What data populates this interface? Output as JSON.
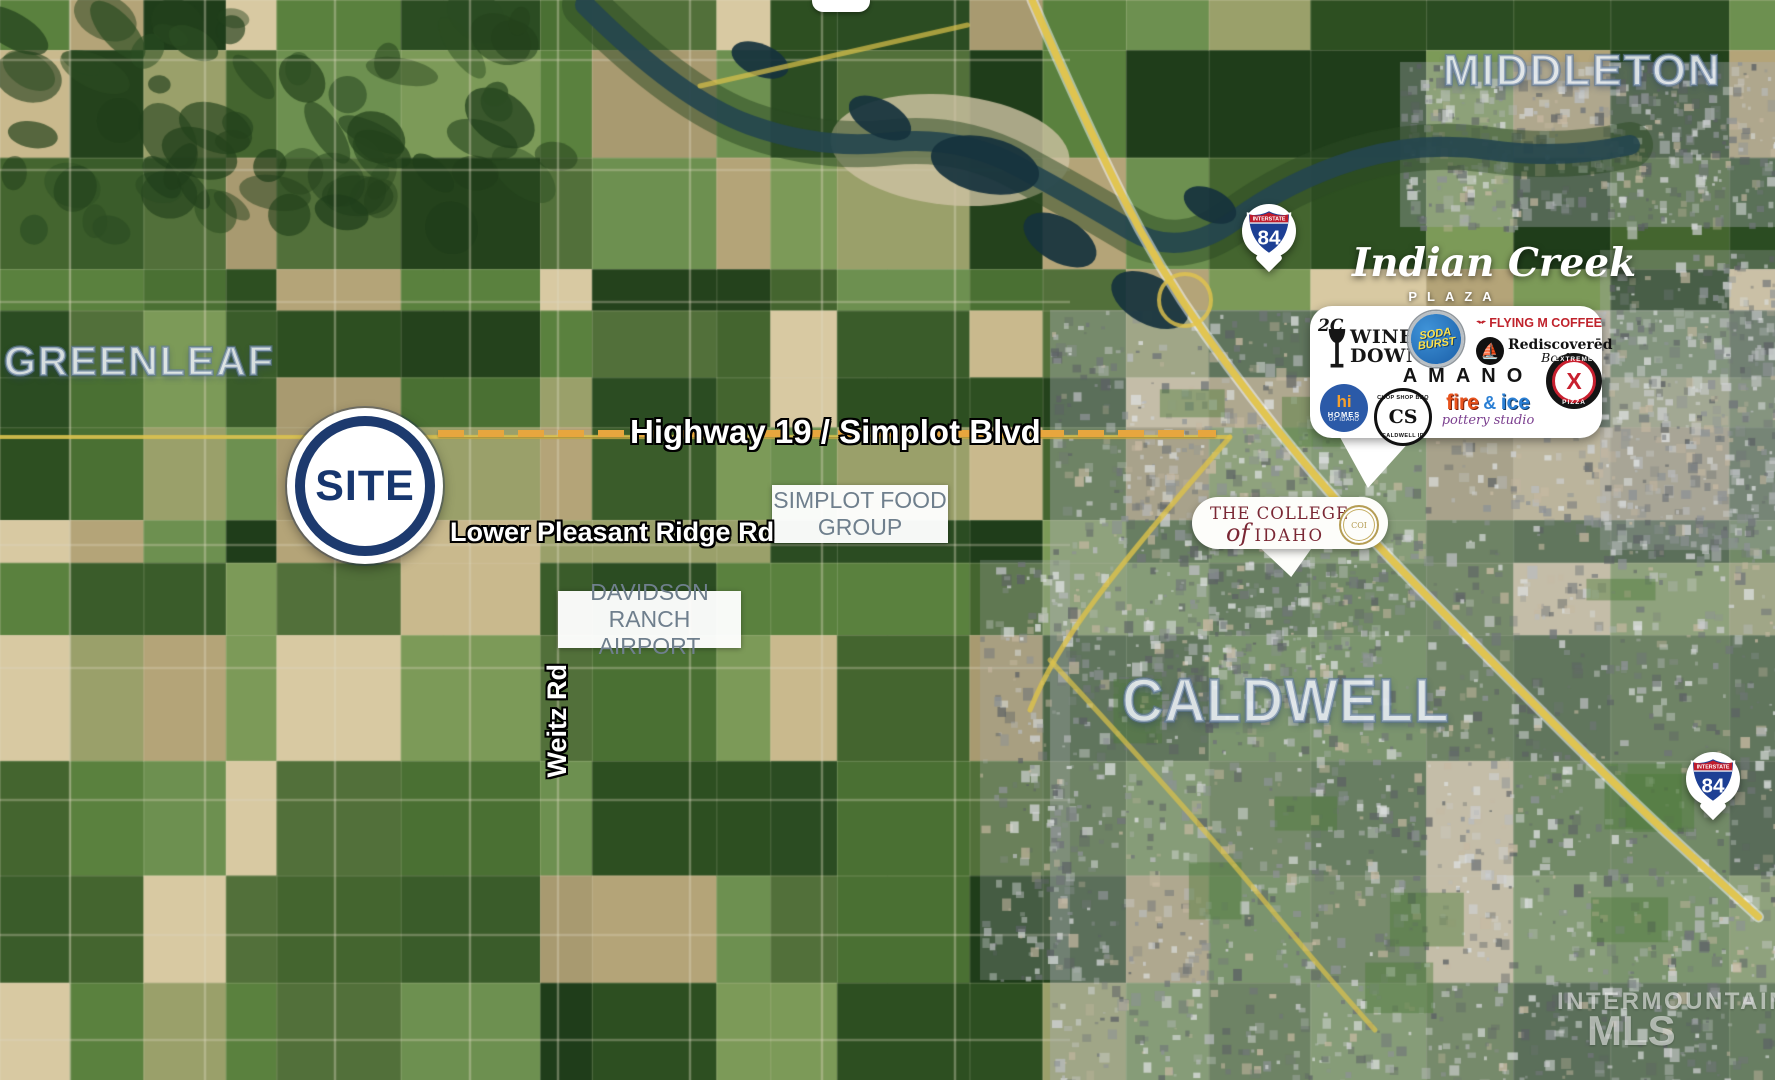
{
  "cities": {
    "middleton": "MIDDLETON",
    "greenleaf": "GREENLEAF",
    "caldwell": "CALDWELL"
  },
  "site": {
    "label": "SITE"
  },
  "roads": {
    "highway19": "Highway 19 / Simplot Blvd",
    "lower_pleasant": "Lower Pleasant Ridge Rd",
    "weitz": "Weitz Rd"
  },
  "pois": {
    "simplot": {
      "line1": "SIMPLOT FOOD",
      "line2": "GROUP"
    },
    "davidson": {
      "line1": "DAVIDSON",
      "line2": "RANCH AIRPORT"
    }
  },
  "interstate": {
    "banner": "INTERSTATE",
    "number": "84"
  },
  "indian_creek": {
    "title": "Indian Creek",
    "subtitle": "PLAZA",
    "logos": {
      "wine_down": {
        "prefix": "2C",
        "line1": "WINE",
        "line2": "DOWN"
      },
      "soda_burst": {
        "line1": "SODA",
        "line2": "BURST"
      },
      "flying_m": {
        "label": "FLYING M COFFEE"
      },
      "rediscovered": {
        "line1": "Rediscoverēd",
        "line2": "Books"
      },
      "amano": {
        "label": "AMANO"
      },
      "extreme": {
        "top": "EXTREME",
        "x": "X",
        "bottom": "PIZZA"
      },
      "homes_idaho": {
        "hi": "hi",
        "line1": "HOMES",
        "line2": "OF IDAHO"
      },
      "chop_shop": {
        "arc_top": "CHOP SHOP BBQ",
        "center": "CS",
        "arc_bottom": "CALDWELL ID"
      },
      "fire_ice": {
        "fire": "fire",
        "amp": "&",
        "ice": "ice",
        "tagline": "pottery studio"
      }
    }
  },
  "college": {
    "line1": "THE COLLEGE",
    "of": "of",
    "line2": "IDAHO",
    "seal": "COI"
  },
  "watermark": {
    "line1": "INTERMOUNTAIN",
    "line2": "MLS"
  },
  "colors": {
    "site_navy": "#17366e",
    "dash_orange": "#e7a63e",
    "poi_slate": "#6f7f8d",
    "shield_red": "#bf1b2c",
    "shield_blue": "#1d3f94",
    "college_maroon": "#7a2734",
    "road_yellow": "#e2c44c"
  }
}
